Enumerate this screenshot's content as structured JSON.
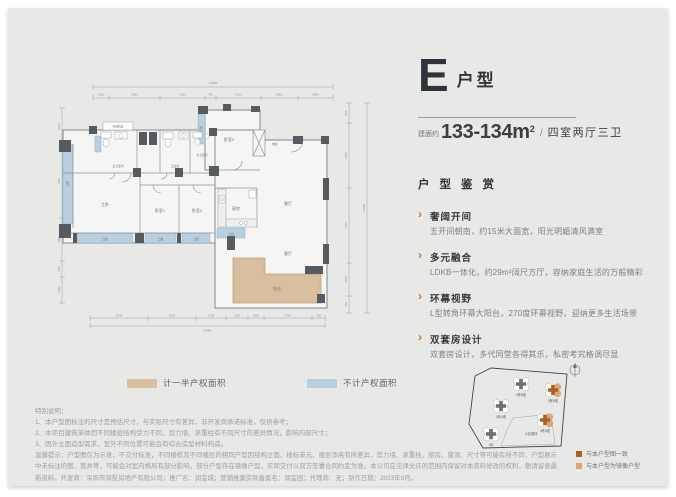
{
  "header": {
    "type_letter": "E",
    "type_suffix": "户型",
    "area_prefix": "建面约",
    "area_value": "133-134m",
    "area_sup": "2",
    "area_slash": "/",
    "layout_label": "四室两厅三卫"
  },
  "appreciation": {
    "title": "户型鉴赏",
    "bullet": "›",
    "items": [
      {
        "title": "奢阔开间",
        "desc": "五开间朝南，约15米大面宽，阳光明媚清风满室"
      },
      {
        "title": "多元融合",
        "desc": "LDKB一体化，约29m²阔尺方厅，容纳家庭生活的万般精彩"
      },
      {
        "title": "环幕视野",
        "desc": "L型转角环幕大阳台，270度环幕视野，迎纳更多生活场景"
      },
      {
        "title": "双套房设计",
        "desc": "双套房设计，多代同堂各得其乐，私密考究格调尽显"
      }
    ]
  },
  "floorplan": {
    "rooms": {
      "ac": "空调机位",
      "master_bath": "主卫生间",
      "bath": "卫生间",
      "second_bath": "次卫生间",
      "master_bed": "主卧",
      "bed1": "卧室1",
      "bed2": "卧室2",
      "bed3": "卧室3",
      "kitchen": "厨房",
      "dining": "餐厅",
      "living": "客厅",
      "balcony": "阳台",
      "shaft": "电井",
      "bay": "凸窗"
    },
    "dims_top": [
      "1150",
      "3600",
      "3200",
      "750",
      "3150",
      "2600",
      "2450"
    ],
    "dims_top_total": "14800",
    "dims_bottom": [
      "3340",
      "2800",
      "1750",
      "1300",
      "900",
      "2750",
      "750"
    ],
    "dims_bottom_total": "14800",
    "dims_left": [
      "2150",
      "4250",
      "2500",
      "950",
      "1500"
    ],
    "dims_right": [
      "875",
      "2850",
      "3300",
      "1450",
      "750"
    ],
    "dims_right_total": "11550",
    "colors": {
      "wall": "#565b5f",
      "bay_blue": "#b7cfdf",
      "balcony_tan": "#d9be9f",
      "accent_orange": "#bf7434"
    }
  },
  "legend": {
    "half_property": "计一半产权面积",
    "no_property": "不计产权面积"
  },
  "notes": {
    "title": "特别说明：",
    "lines": [
      "1、本户型图标注的尺寸是预估尺寸，与实际尺寸有差异，非开发商承诺标准，仅供参考；",
      "2、本项目建筑单体因不同楼层结构受力不同，剪力墙、承重柱有不同尺寸的差异情况，影响内部尺寸；",
      "3、因外立面造型需求，室外不同位置可能会有综合造型材料构造。"
    ]
  },
  "disclaimer": "温馨提示：户型图仅为示意，不交付标准，不同楼栋及不同楼层的相同户型因结构立面、楼标单元、楼层净高有所差异，剪力墙、承重柱、厨房、窗洞、尺寸等可能有所不同，户型展示中未标注的图、管井等，可能会对室内格局有部分影响，部分户型存在镜像户型，实际交付以双方签署合同约定为准，本公司在法律允许的范围内保留对本资料修改的权利，敬请留意最新资料。开发商：深圳市润投房地产有限公司；推广名：润玺城；营销推案实际备案名：润玺园；代理商：无；制作日期：2023年9月。",
  "siteplan": {
    "buildings": [
      "2栋B座",
      "2栋A座",
      "1栋",
      "3栋B座",
      "3栋A座"
    ],
    "center_label": "小区园林",
    "legend": [
      {
        "label": "与本户型图一致",
        "color": "#b05f1f"
      },
      {
        "label": "与本户型为镜像户型",
        "color": "#d8a77c"
      }
    ]
  }
}
